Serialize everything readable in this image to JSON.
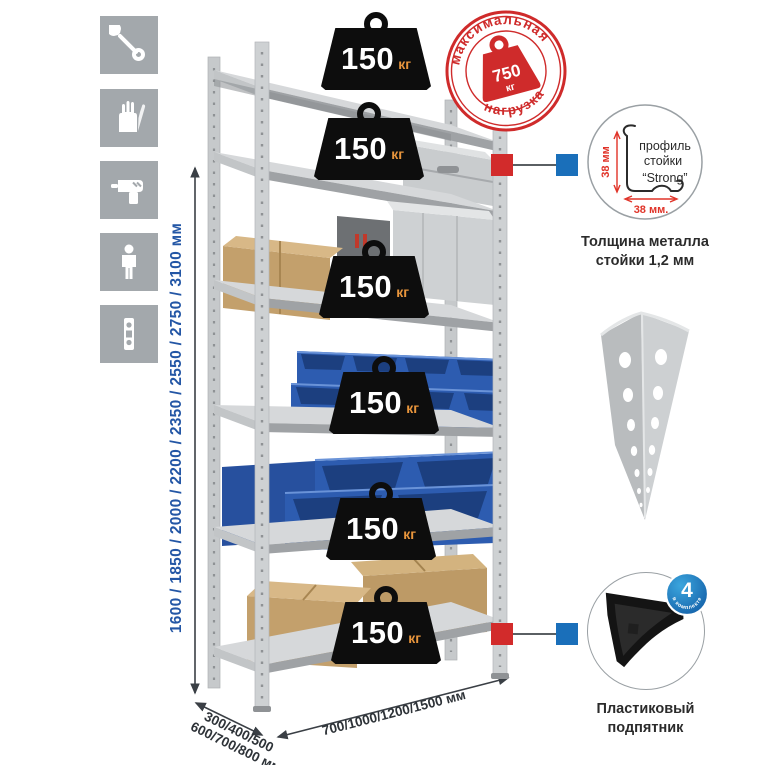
{
  "sidebar": {
    "icons": [
      {
        "name": "wrench-icon"
      },
      {
        "name": "gloves-icon"
      },
      {
        "name": "drill-icon"
      },
      {
        "name": "person-icon"
      },
      {
        "name": "post-icon"
      }
    ]
  },
  "dimensions": {
    "height": "1600 / 1850 / 2000 / 2200 / 2350 / 2550 / 2750 / 3100 мм",
    "depth_line1": "300/400/500",
    "depth_line2": "600/700/800 мм",
    "width": "700/1000/1200/1500 мм"
  },
  "shelf_loads": [
    {
      "value": "150",
      "unit": "кг"
    },
    {
      "value": "150",
      "unit": "кг"
    },
    {
      "value": "150",
      "unit": "кг"
    },
    {
      "value": "150",
      "unit": "кг"
    },
    {
      "value": "150",
      "unit": "кг"
    },
    {
      "value": "150",
      "unit": "кг"
    }
  ],
  "max_load_stamp": {
    "arc_top": "максимальная",
    "arc_bottom": "нагрузка",
    "value": "750",
    "unit": "кг"
  },
  "profile_callout": {
    "line1": "профиль",
    "line2": "стойки",
    "line3": "“Strong”",
    "dim_vertical": "38 мм",
    "dim_horizontal": "38 мм.",
    "caption1": "Толщина металла",
    "caption2": "стойки 1,2 мм"
  },
  "foot_callout": {
    "badge_number": "4",
    "badge_arc": "в комплекте",
    "caption1": "Пластиковый",
    "caption2": "подпятник"
  },
  "colors": {
    "stamp_red": "#cf2b2b",
    "connector_red": "#d22b2b",
    "connector_blue": "#1a6fba",
    "dimension_blue": "#2356a5",
    "weight_unit_orange": "#e8953c",
    "bin_blue": "#2d5cb0",
    "badge_blue": "#1c75bc",
    "icon_gray": "#a3a8ac"
  }
}
